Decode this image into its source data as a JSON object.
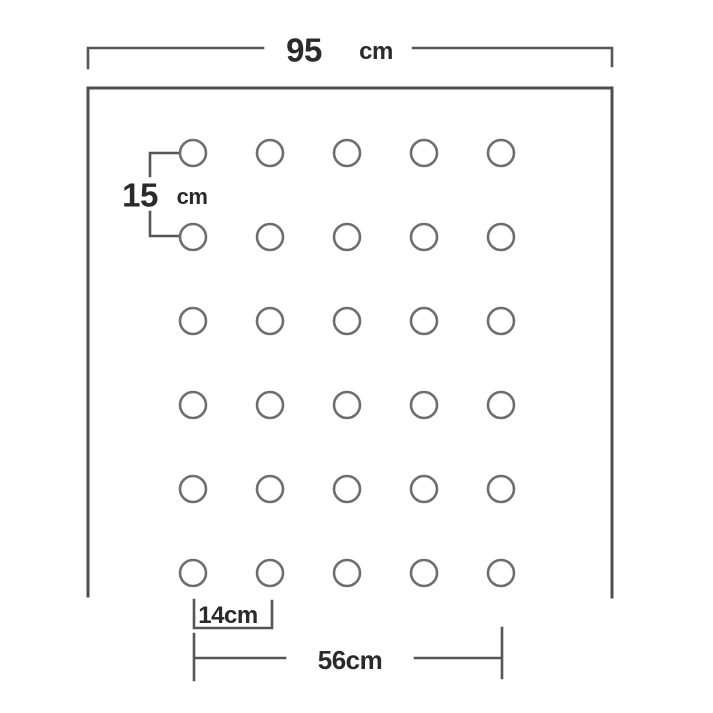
{
  "diagram": {
    "width_dimension": {
      "value": "95",
      "unit": "cm"
    },
    "row_spacing_dimension": {
      "value": "15",
      "unit": "cm"
    },
    "hole_spacing_dimension": {
      "label": "14cm"
    },
    "row_span_dimension": {
      "label": "56cm"
    },
    "hole_grid": {
      "rows": 6,
      "columns": 5
    },
    "colors": {
      "outline": "#4f4f4f",
      "dimension_line": "#565656",
      "hole_stroke": "#6e6e6e",
      "text": "#2a2a2a",
      "background": "#ffffff"
    }
  }
}
